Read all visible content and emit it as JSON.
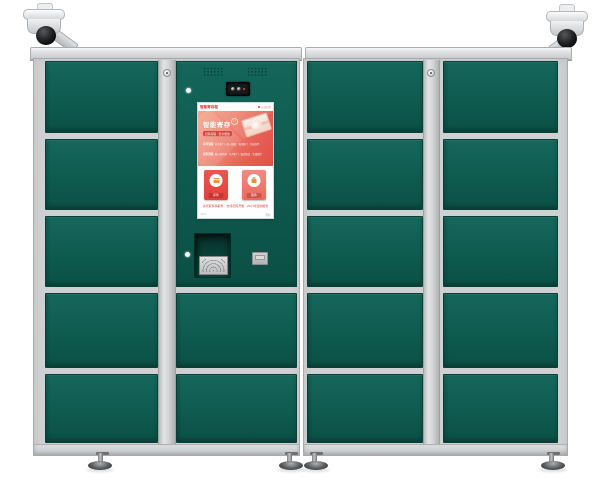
{
  "product": {
    "type": "smart parcel locker cabinet",
    "left_camera": "dome-surveillance-camera",
    "right_camera": "dome-surveillance-camera",
    "door_count_left_cabinet": 7,
    "door_count_right_cabinet": 10
  },
  "screen": {
    "header": {
      "brand": "智能寄存柜",
      "info": "欢迎使用"
    },
    "banner": {
      "title": "智能寄存",
      "refresh_icon": "↻",
      "badge": "扫码存取 · 安全便捷",
      "row1_label": "存件流程",
      "row1_text": "打开柜门 · 放入物品 · 关闭柜门 · 完成存件",
      "row2_label": "取件流程",
      "row2_text": "输入取件码 · 打开柜门 · 取出物品 · 完成取件"
    },
    "cards": [
      {
        "label": "存件",
        "icon": "deposit-parcel-icon"
      },
      {
        "label": "取件",
        "icon": "pickup-parcel-icon"
      }
    ],
    "notice": "请凭取件码取件 · 支持扫码开柜 · 24小时自助服务",
    "footer": {
      "left": "V2.0",
      "right": "帮助"
    }
  },
  "colors": {
    "door_green": "#0f5b50",
    "frame_gray": "#ced0d2",
    "screen_red": "#e2514b",
    "banner_gradient_from": "#f5a88e",
    "banner_gradient_to": "#e2514b"
  }
}
